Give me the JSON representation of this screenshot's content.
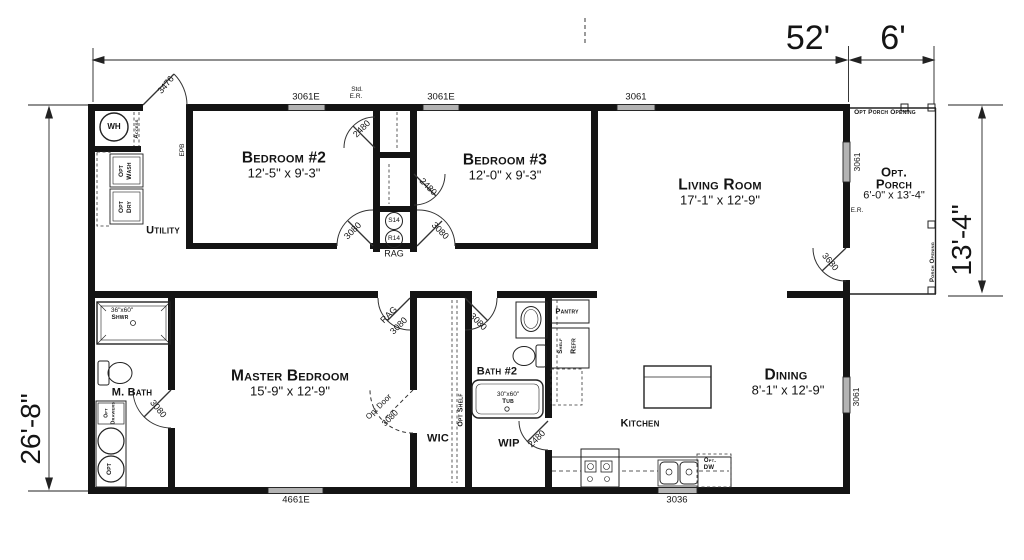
{
  "canvas": {
    "ink": "#141414",
    "window_fill": "#b3b3b3",
    "background": "#ffffff"
  },
  "dimensions": {
    "overall_width": "52'",
    "porch_width": "6'",
    "left_height": "26'-8\"",
    "right_height": "13'-4\""
  },
  "rooms": {
    "bedroom2": {
      "name": "Bedroom #2",
      "size": "12'-5\" x 9'-3\""
    },
    "bedroom3": {
      "name": "Bedroom #3",
      "size": "12'-0\" x 9'-3\""
    },
    "living": {
      "name": "Living Room",
      "size": "17'-1\" x 12'-9\""
    },
    "master": {
      "name": "Master Bedroom",
      "size": "15'-9\" x 12'-9\""
    },
    "dining": {
      "name": "Dining",
      "size": "8'-1\" x 12'-9\""
    },
    "porch": {
      "name_line1": "Opt.",
      "name_line2": "Porch",
      "size": "6'-0\" x 13'-4\"",
      "opening_top": "Opt Porch Opening",
      "opening_right": "Porch Opening",
      "er": "E.R."
    },
    "utility": {
      "name": "Utility"
    },
    "mbath": {
      "name": "M. Bath"
    },
    "bath2": {
      "name": "Bath #2"
    },
    "wic": {
      "name": "WIC"
    },
    "wip": {
      "name": "WIP"
    },
    "kitchen": {
      "name": "Kitchen"
    }
  },
  "windows": {
    "top_left": "3061E",
    "top_mid": "3061E",
    "top_right": "3061",
    "porch": "3061",
    "dining": "3061",
    "bottom_left": "4661E",
    "bottom_kitchen": "3036"
  },
  "doors": {
    "entry": "3476",
    "closet1": "2480",
    "closet2": "2480",
    "bedroom2": "3080",
    "bedroom3": "3080",
    "porch": "3680",
    "master_rag": "RAG",
    "master": "3080",
    "bath2": "3080",
    "mbath": "3080",
    "opt_door_label": "Opt Door",
    "opt_door_size": "3080",
    "wip": "2480"
  },
  "fixtures": {
    "water_heater": "WH",
    "access": "Access",
    "shelf_w16x30": "W16X30",
    "opt_wash_1": "Opt",
    "opt_wash_2": "Wash",
    "opt_dry_1": "Opt",
    "opt_dry_2": "Dry",
    "epb": "EPB",
    "std": "Std.",
    "er": "E.R.",
    "s14": "S14",
    "r14": "R14",
    "rag": "RAG",
    "shower_size": "36\"x60\"",
    "shower": "Shwr",
    "opt_drawers_1": "Opt",
    "opt_drawers_2": "Drawers",
    "opt_sink": "Opt",
    "opt_shelf": "Opt Shelf",
    "tub_size": "30\"x60\"",
    "tub": "Tub",
    "pantry": "Pantry",
    "refr": "Refr",
    "shelf": "Shelf",
    "opt_dw_1": "Opt.",
    "opt_dw_2": "DW"
  }
}
